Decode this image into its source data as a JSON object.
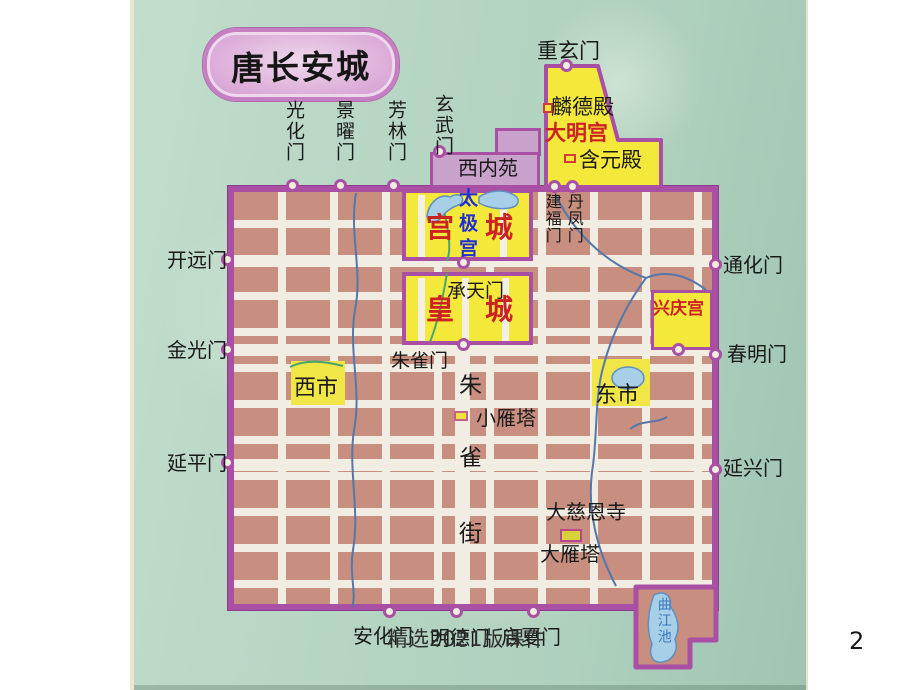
{
  "slide": {
    "footer": "精选2021版课件",
    "page_number": "2"
  },
  "title": "唐长安城",
  "gates": {
    "north": [
      "光化门",
      "景曜门",
      "芳林门",
      "玄武门"
    ],
    "west": [
      "开远门",
      "金光门",
      "延平门"
    ],
    "east": [
      "通化门",
      "春明门",
      "延兴门"
    ],
    "south": [
      "安化门",
      "明德门",
      "启夏门"
    ],
    "daming_north": "重玄门",
    "palace_top": [
      "建福门",
      "丹凤门"
    ],
    "chengtian": "承天门",
    "zhuque": "朱雀门"
  },
  "regions": {
    "daming_palace": "大明宫",
    "linde_hall": "麟德殿",
    "hanyuan_hall": "含元殿",
    "west_inner_park": "西内苑",
    "palace_city_left": "宫",
    "palace_city_right": "城",
    "taiji_palace": "太极宫",
    "imperial_city_left": "皇",
    "imperial_city_right": "城",
    "xingqing_palace": "兴庆宫",
    "west_market": "西市",
    "east_market": "东市"
  },
  "street": {
    "chars": [
      "朱",
      "雀",
      "街"
    ]
  },
  "landmarks": {
    "small_goose_pagoda": "小雁塔",
    "daci_en_temple": "大慈恩寺",
    "big_goose_pagoda": "大雁塔",
    "qujiang_pool": "曲江池"
  },
  "colors": {
    "map_background": "#b7d6c4",
    "wall_purple": "#a94fa4",
    "city_block": "#c88e80",
    "street_white": "#f2ede3",
    "palace_yellow": "#f4e83b",
    "park_purple": "#c9a2cb",
    "highlight_red": "#cc2222",
    "label_blue": "#1f2fd4",
    "water_blue": "#a8cfe8",
    "title_fill": "#d9a6d5"
  }
}
